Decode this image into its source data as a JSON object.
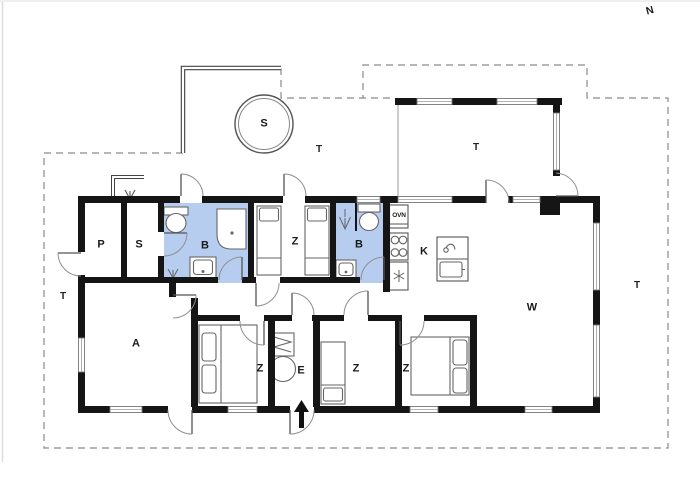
{
  "plan": {
    "compass": "N",
    "rooms": [
      {
        "key": "p",
        "label": "P"
      },
      {
        "key": "sauna",
        "label": "S"
      },
      {
        "key": "bath-1",
        "label": "B"
      },
      {
        "key": "bedroom-1",
        "label": "Z"
      },
      {
        "key": "bath-2",
        "label": "B"
      },
      {
        "key": "kitchen",
        "label": "K"
      },
      {
        "key": "living",
        "label": "W"
      },
      {
        "key": "activity",
        "label": "A"
      },
      {
        "key": "bedroom-2",
        "label": "Z"
      },
      {
        "key": "entry",
        "label": "E"
      },
      {
        "key": "bedroom-3",
        "label": "Z"
      },
      {
        "key": "bedroom-4",
        "label": "Z"
      }
    ],
    "outdoor_labels": [
      {
        "key": "terrace-west",
        "label": "T"
      },
      {
        "key": "terrace-north",
        "label": "T"
      },
      {
        "key": "terrace-covered",
        "label": "T"
      },
      {
        "key": "terrace-east",
        "label": "T"
      }
    ],
    "spa_label": "S",
    "oven_label": "OVN"
  },
  "colors": {
    "bath_floor": "#b7cdf0",
    "wall": "#151515",
    "thin_line": "#666666",
    "dash": "#8a8a8a"
  }
}
